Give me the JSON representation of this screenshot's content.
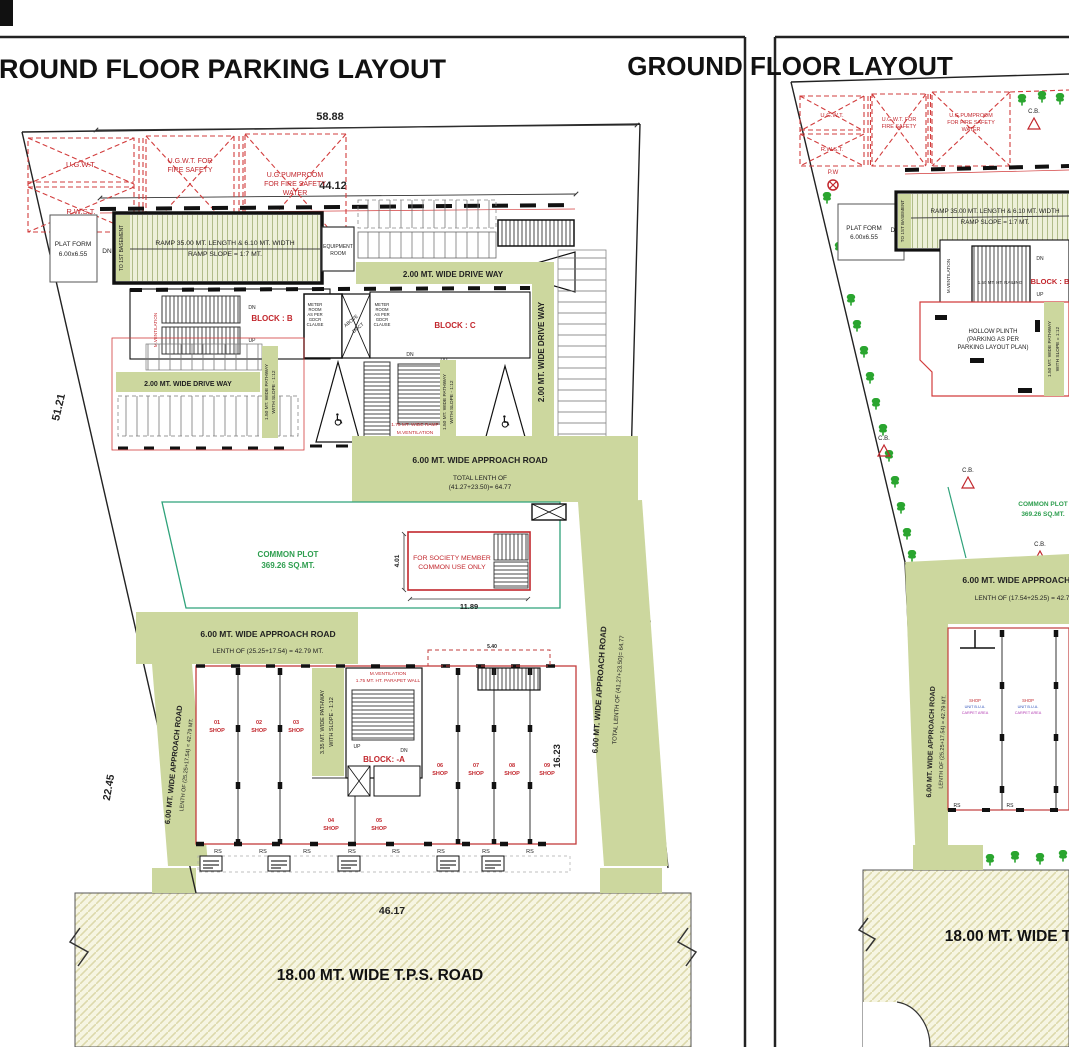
{
  "left": {
    "title": "GROUND FLOOR PARKING LAYOUT",
    "dim58": "58.88",
    "dim44": "44.12",
    "dim51": "51.21",
    "dim22": "22.45",
    "dim52": "52.19",
    "dim46": "46.17",
    "dim1189": "11.89",
    "dim401": "4.01",
    "dim1623": "16.23",
    "dim540": "5.40",
    "ugwt": "U.G.W.T.",
    "rwst": "R.W.S.T.",
    "ugwt_fire1": "U.G.W.T. FOR",
    "ugwt_fire2": "FIRE SAFETY",
    "pump1": "U.G.PUMPROOM",
    "pump2": "FOR FIRE SAFETY",
    "pump3": "WATER",
    "platform1": "PLAT FORM",
    "platform2": "6.00x6.55",
    "dn": "DN",
    "up": "UP",
    "basement": "TO 1ST BASEMENT",
    "ramp1": "RAMP 35.00 MT. LENGTH & 6.10 MT. WIDTH",
    "ramp2": "RAMP SLOPE = 1:7 MT.",
    "equip1": "EQUIPMENT",
    "equip2": "ROOM",
    "driveway": "2.00 MT. WIDE DRIVE WAY",
    "blockB": "BLOCK : B",
    "blockC": "BLOCK : C",
    "blockA": "BLOCK: -A",
    "meter1": "METER",
    "meter2": "ROOM",
    "meter3": "AS PER",
    "meter4": "GDCR",
    "meter5": "CLAUSE",
    "duct1": "ABOVE",
    "duct2": "DUCT",
    "path150a": "1.50 MT. WIDE PATHWAY",
    "path150b": "WITH SLOPE - 1:12",
    "path335a": "3.35 MT. WIDE PATHWAY",
    "path335b": "WITH SLOPE - 1:12",
    "mvent": "M.VENTILATION",
    "ramp175": "1.75 MT. WIDE RAMP",
    "parapet": "1.75 MT. HT. PARAPET WALL",
    "approach": "6.00 MT. WIDE APPROACH ROAD",
    "total1": "TOTAL LENTH OF",
    "total2": "(41.27+23.50)= 64.77",
    "total_inline": "TOTAL LENTH OF (41.27+23.50)= 64.77",
    "lenth2542": "LENTH OF (25.25+17.54) = 42.79 MT.",
    "common1": "COMMON PLOT",
    "common2": "369.26 SQ.MT.",
    "society1": "FOR SOCIETY MEMBER",
    "society2": "COMMON USE ONLY",
    "shopword": "SHOP",
    "shops": [
      "01",
      "02",
      "03",
      "04",
      "05",
      "06",
      "07",
      "08",
      "09"
    ],
    "rs": "RS",
    "road": "18.00 MT. WIDE T.P.S. ROAD"
  },
  "right": {
    "title": "GROUND FLOOR LAYOUT",
    "cb": "C.B.",
    "pw": "P.W",
    "hollow1": "HOLLOW PLINTH",
    "hollow2": "(PARKING AS PER",
    "hollow3": "PARKING LAYOUT PLAN)",
    "lenth1725": "LENTH OF (17.54+25.25) = 42.79 MT.",
    "railing": "1.50 MT. HT. RAILING",
    "path150a": "1.50 MT. WIDE PATHWAY",
    "path150b": "WITH SLOPE = 1:12",
    "shopword": "SHOP",
    "unit_bua": "UNIT B.U.A.",
    "carpet": "CARPET AREA"
  }
}
